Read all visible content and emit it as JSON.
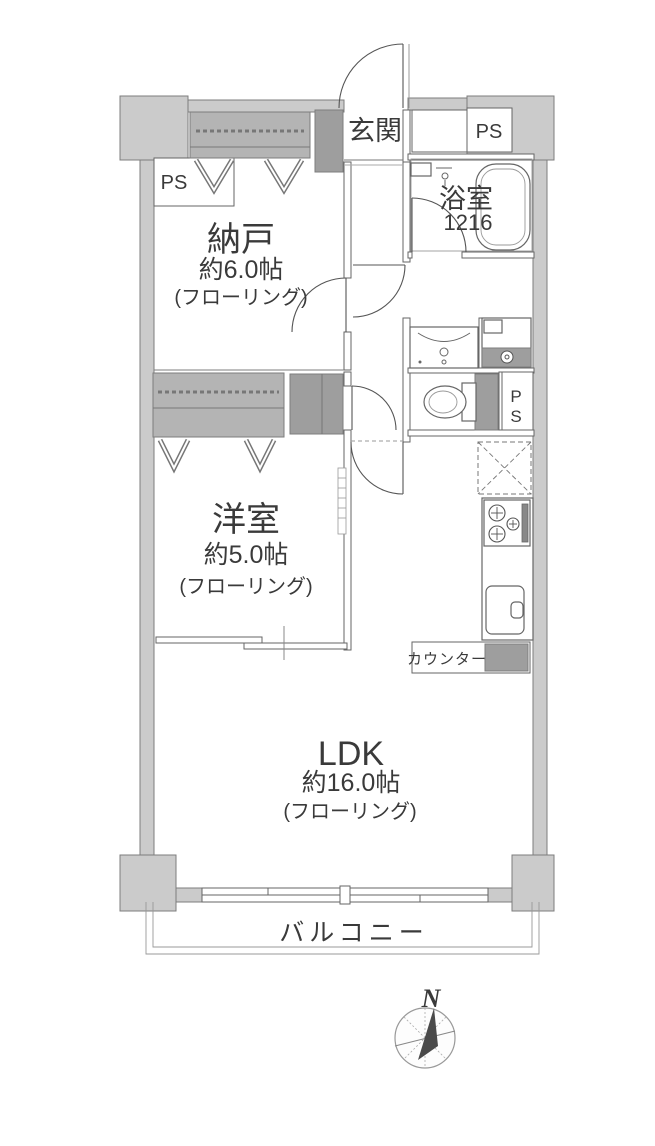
{
  "rooms": {
    "entrance": {
      "name": "玄関"
    },
    "storage": {
      "name": "納戸",
      "size": "約6.0帖",
      "flooring": "(フローリング)"
    },
    "bathroom": {
      "name": "浴室",
      "size": "1216"
    },
    "western": {
      "name": "洋室",
      "size": "約5.0帖",
      "flooring": "(フローリング)"
    },
    "ldk": {
      "name": "LDK",
      "size": "約16.0帖",
      "flooring": "(フローリング)"
    },
    "balcony": {
      "name": "バルコニー"
    },
    "counter": {
      "name": "カウンター"
    }
  },
  "utility": {
    "ps_top_left": "PS",
    "ps_top_right": "PS",
    "ps_mid_p": "P",
    "ps_mid_s": "S"
  },
  "compass": {
    "north": "N"
  },
  "colors": {
    "wall_fill": "#cbcbcb",
    "wall_dark": "#9e9e9e",
    "closet_fill": "#b4b4b4",
    "line": "#666666",
    "text": "#3a3a3a"
  }
}
